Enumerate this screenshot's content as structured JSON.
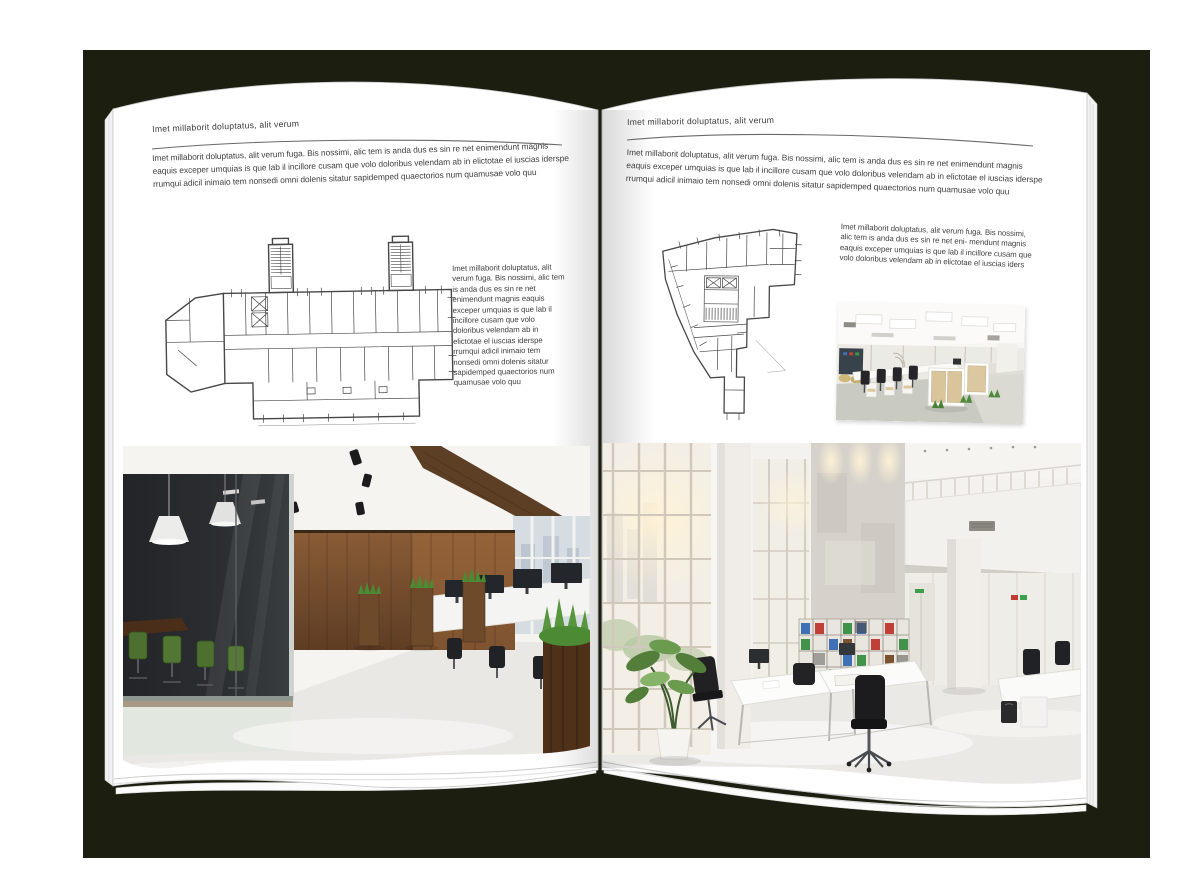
{
  "left_page": {
    "header": "Imet millaborit doluptatus, alit verum",
    "intro": "Imet millaborit doluptatus, alit verum fuga. Bis nossimi, alic tem is anda dus es sin re net enimendunt magnis eaquis exceper umquias is que lab il incillore cusam que volo doloribus velendam ab in elictotae el iuscias iderspe rrumqui adicil inimaio tem nonsedi omni dolenis sitatur sapidemped quaectorios num quamusae volo quu",
    "column": "Imet millaborit doluptatus, alit verum fuga. Bis nossimi, alic tem is anda dus es sin re net enimendunt magnis eaquis exceper umquias is que lab il incillore cusam que volo doloribus velendam ab in elictotae el iuscias iderspe rrumqui adicil inimaio tem nonsedi omni dolenis sitatur sapidemped quaectorios num quamusae volo quu"
  },
  "right_page": {
    "header": "Imet millaborit doluptatus, alit verum",
    "intro": "Imet millaborit doluptatus, alit verum fuga. Bis nossimi, alic tem is anda dus es sin re net enimendunt magnis eaquis exceper umquias is que lab il incillore cusam que volo doloribus velendam ab in elictotae el iuscias iderspe rrumqui adicil inimaio tem nonsedi omni dolenis sitatur sapidemped quaectorios num quamusae volo quu",
    "column": "Imet millaborit doluptatus, alit verum fuga. Bis nossimi, alic tem is anda dus es sin re net eni- mendunt magnis eaquis exceper umquias is que lab il incillore cusam que volo doloribus velendam ab in elictotae el iuscias iders"
  },
  "images": {
    "left_floorplan": "Floor plan, office wing with two stairwells",
    "right_floorplan": "Floor plan, wedge-shaped office building",
    "left_photo": "Loft office interior with dark glass meeting room, green chairs and wood wall",
    "right_photo": "Bright double-height open office with glazed facade, bookshelf wall and mezzanine",
    "small_photo": "Open-plan office with light wood workstations"
  },
  "colors": {
    "backdrop": "#1c1e10",
    "page": "#ffffff",
    "text": "#3f3f3f",
    "rule": "#6a6a6a",
    "plan_line": "#474747",
    "wood": "#7b5334",
    "wood_dark": "#4f3119",
    "glass_dark": "#26282b",
    "green_chair": "#4d7030",
    "grass": "#4c8a33",
    "window": "#d5dde3",
    "sun": "#fff3d6",
    "concrete": "#d6d2cb",
    "floor": "#e9e8e4",
    "binder_blue": "#3f6fb5",
    "binder_green": "#42934a",
    "binder_red": "#c04038",
    "chair_black": "#1f2022"
  }
}
